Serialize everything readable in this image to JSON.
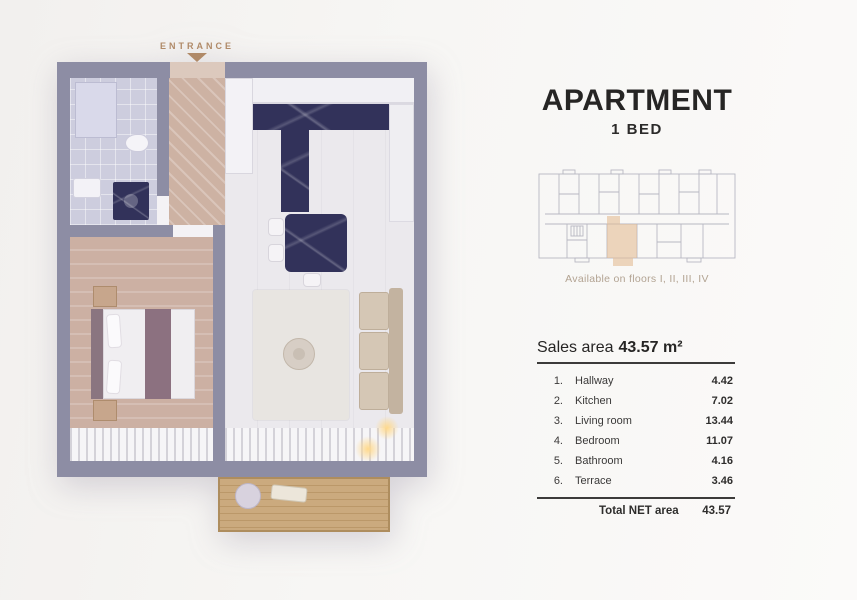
{
  "plan": {
    "entrance_label": "ENTRANCE",
    "wall_color": "#8d8da4",
    "accent_color": "#b08a68"
  },
  "header": {
    "title": "APARTMENT",
    "subtitle": "1 BED"
  },
  "location": {
    "caption": "Available on floors I, II, III, IV",
    "highlight_color": "#e3bd95"
  },
  "sales": {
    "label": "Sales area",
    "value": "43.57 m²"
  },
  "rooms": {
    "rows": [
      {
        "num": "1.",
        "name": "Hallway",
        "area": "4.42"
      },
      {
        "num": "2.",
        "name": "Kitchen",
        "area": "7.02"
      },
      {
        "num": "3.",
        "name": "Living room",
        "area": "13.44"
      },
      {
        "num": "4.",
        "name": "Bedroom",
        "area": "11.07"
      },
      {
        "num": "5.",
        "name": "Bathroom",
        "area": "4.16"
      },
      {
        "num": "6.",
        "name": "Terrace",
        "area": "3.46"
      }
    ],
    "total_label": "Total NET area",
    "total_value": "43.57"
  }
}
